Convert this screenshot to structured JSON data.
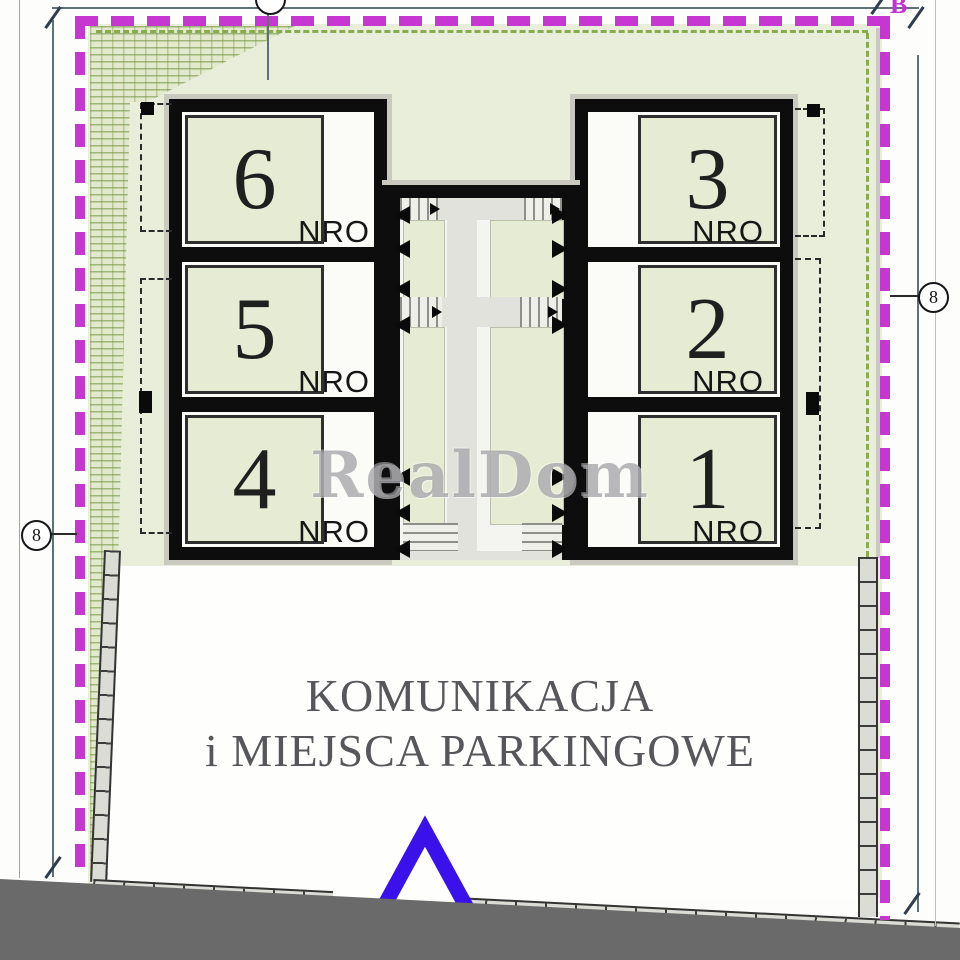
{
  "watermark": "RealDom",
  "parking": {
    "line1": "KOMUNIKACJA",
    "line2": "i MIEJSCA PARKINGOWE"
  },
  "building": {
    "left_units": [
      {
        "number": "6",
        "label": "NRO"
      },
      {
        "number": "5",
        "label": "NRO"
      },
      {
        "number": "4",
        "label": "NRO"
      }
    ],
    "right_units": [
      {
        "number": "3",
        "label": "NRO"
      },
      {
        "number": "2",
        "label": "NRO"
      },
      {
        "number": "1",
        "label": "NRO"
      }
    ]
  },
  "dimensions": {
    "left_badge": "8",
    "right_badge": "8",
    "corner_label": "B"
  },
  "colors": {
    "boundary_magenta": "#c636d0",
    "site_green": "#e9eeda",
    "unit_green": "#e6ecd3",
    "wall_black": "#0d0d0d",
    "road_gray": "#6a6a6a",
    "entrance_arrow_blue": "#3a11ea",
    "text_gray": "#56565b"
  }
}
